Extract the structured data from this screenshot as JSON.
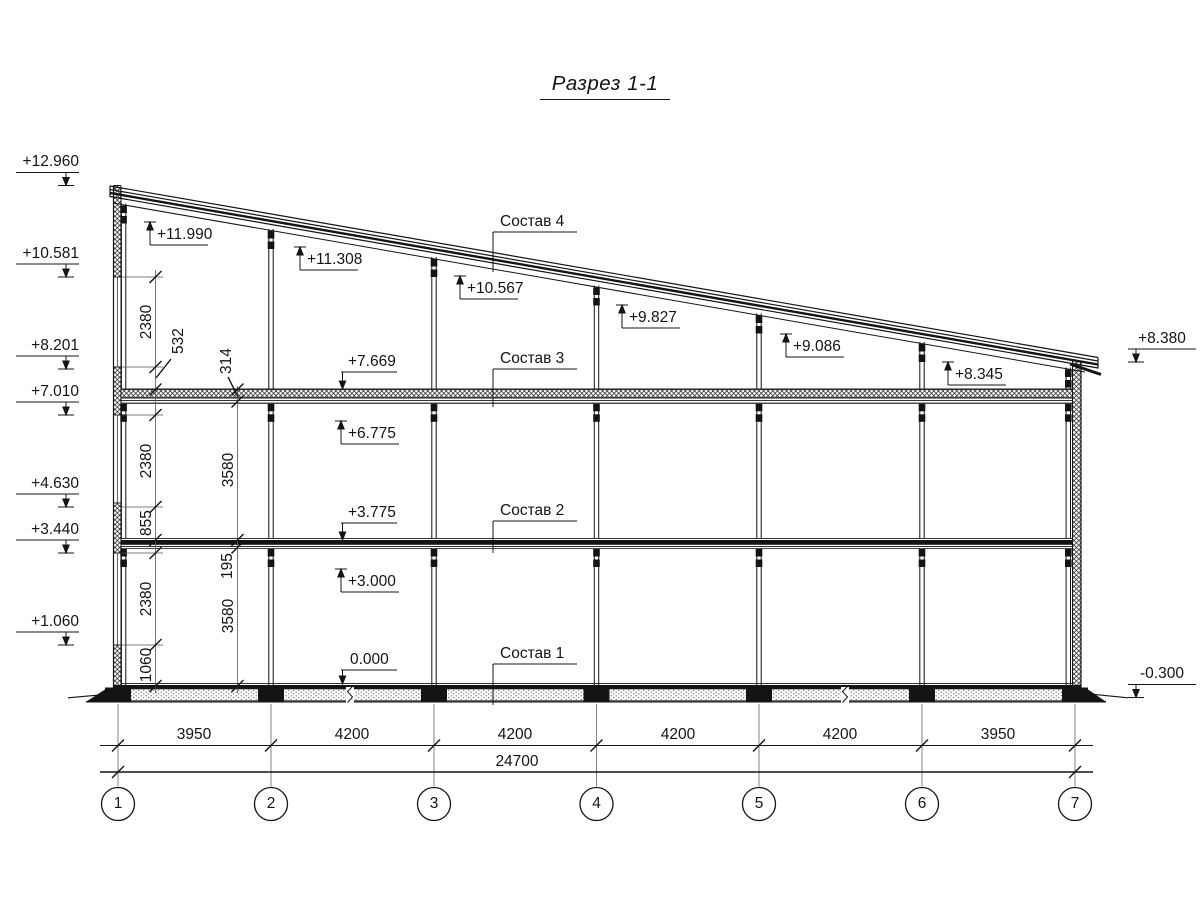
{
  "title": "Разрез 1-1",
  "marks_left": [
    "+12.960",
    "+10.581",
    "+8.201",
    "+7.010",
    "+4.630",
    "+3.440",
    "+1.060"
  ],
  "marks_right": [
    "+8.380",
    "-0.300"
  ],
  "marks_interior": [
    "+11.990",
    "+11.308",
    "+10.567",
    "+9.827",
    "+9.086",
    "+8.345",
    "+7.669",
    "+6.775",
    "+3.775",
    "+3.000",
    "0.000"
  ],
  "layers": [
    "Состав 4",
    "Состав 3",
    "Состав 2",
    "Состав 1"
  ],
  "dims_left_chain": [
    "2380",
    "532",
    "2380",
    "855",
    "2380",
    "1060"
  ],
  "dims_inner_chain": [
    "314",
    "3580",
    "195",
    "3580"
  ],
  "dims_horizontal": [
    "3950",
    "4200",
    "4200",
    "4200",
    "4200",
    "3950"
  ],
  "dim_total": "24700",
  "grid_axes": [
    "1",
    "2",
    "3",
    "4",
    "5",
    "6",
    "7"
  ],
  "colors": {
    "line": "#141414",
    "background": "#ffffff"
  }
}
